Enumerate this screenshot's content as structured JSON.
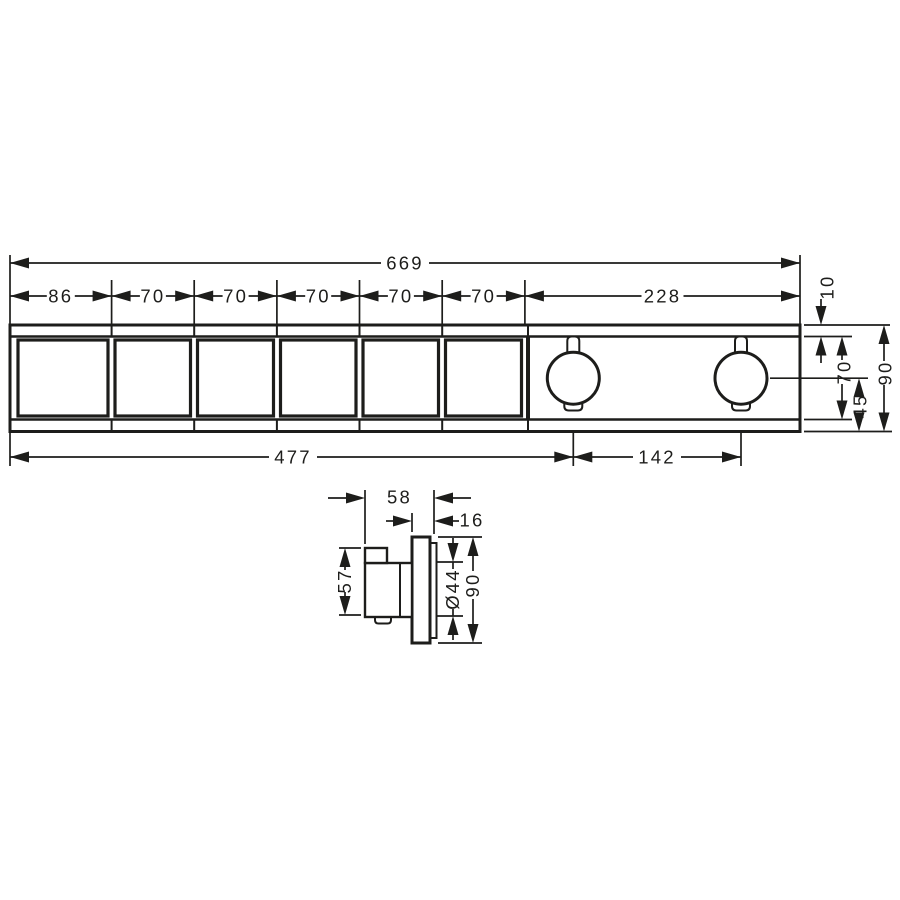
{
  "meta": {
    "drawing_type": "technical dimension drawing",
    "views": [
      "front view",
      "side view"
    ],
    "units": "mm",
    "line_color": "#1d1d1b",
    "background_color": "#ffffff"
  },
  "front_view": {
    "overall_width": "669",
    "segments": [
      "86",
      "70",
      "70",
      "70",
      "70",
      "70",
      "228"
    ],
    "right": {
      "lip": "10",
      "body_height": "70",
      "center_to_bottom": "45",
      "total_height": "90"
    },
    "bottom": {
      "left_to_first_knob": "477",
      "knob_spacing": "142"
    },
    "features": {
      "button_count": 6,
      "knob_count": 2
    }
  },
  "side_view": {
    "total_depth": "58",
    "plate_thickness": "16",
    "handle_height": "57",
    "knob_diameter": "Ø44",
    "plate_height": "90"
  }
}
